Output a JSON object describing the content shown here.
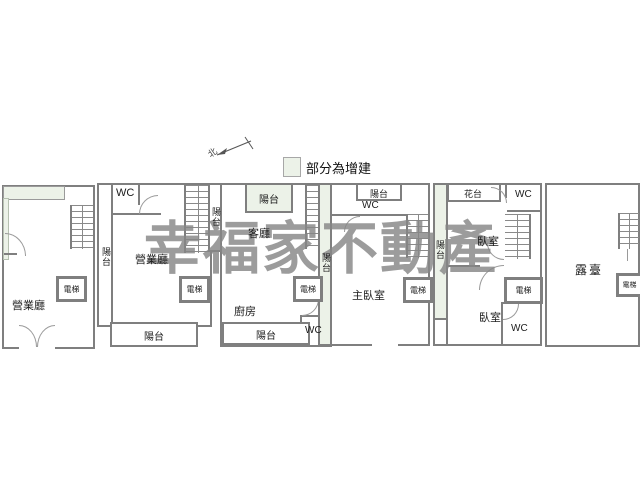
{
  "watermark": "幸福家不動產",
  "legend": {
    "label": "部分為增建",
    "swatch_color": "#ecf2e8"
  },
  "north": {
    "label": "北"
  },
  "colors": {
    "wall": "#7f7f7f",
    "addition_fill": "#ecf2e8",
    "watermark": "#878787"
  },
  "plans": {
    "p1": {
      "labels": {
        "hall": "營業廳",
        "elevator": "電梯"
      }
    },
    "p2": {
      "labels": {
        "wc": "WC",
        "balcony_left": "陽台",
        "hall": "營業廳",
        "elevator": "電梯",
        "balcony_bottom": "陽台"
      }
    },
    "p3": {
      "labels": {
        "balcony_left": "陽台",
        "balcony_top": "陽台",
        "living": "客廳",
        "elevator": "電梯",
        "kitchen": "廚房",
        "wc": "WC",
        "balcony_bottom": "陽台"
      }
    },
    "p4": {
      "labels": {
        "balcony_top": "陽台",
        "wc": "WC",
        "balcony_left": "陽台",
        "master": "主臥室",
        "elevator": "電梯"
      }
    },
    "p5": {
      "labels": {
        "flower": "花台",
        "wc_top": "WC",
        "balcony_left": "陽台",
        "bed_upper": "臥室",
        "elevator": "電梯",
        "bed_lower": "臥室",
        "wc_bottom": "WC"
      }
    },
    "p6": {
      "labels": {
        "terrace": "露臺",
        "elevator": "電梯"
      }
    }
  }
}
